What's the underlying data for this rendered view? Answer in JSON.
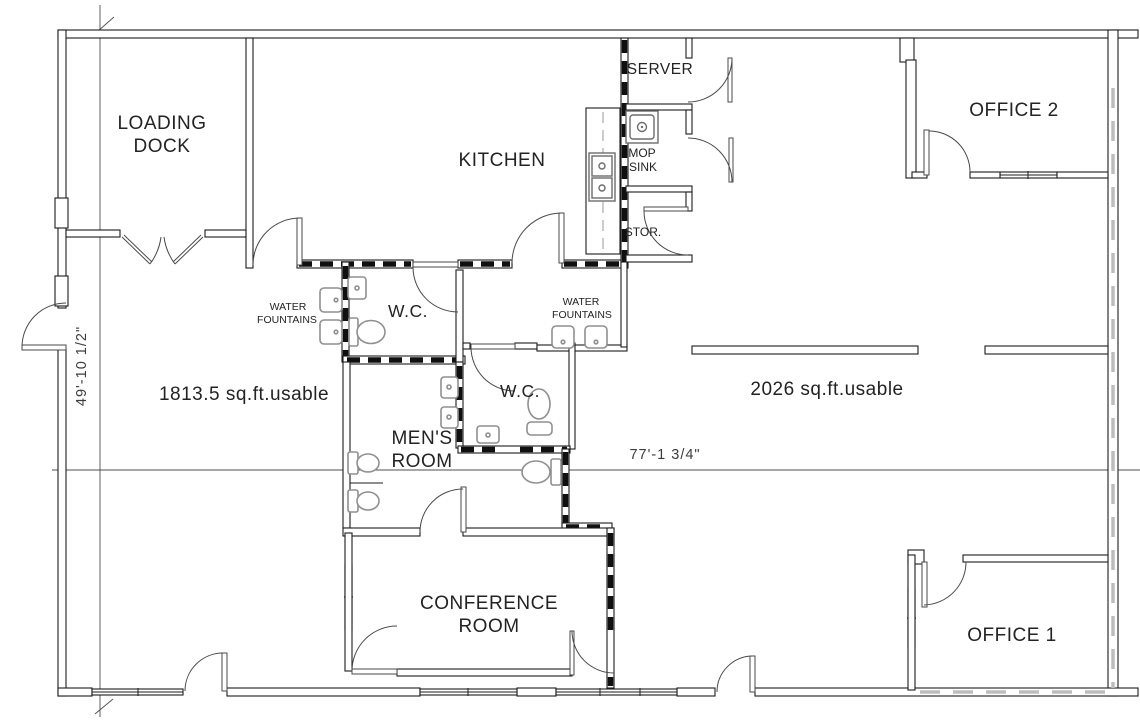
{
  "labels": {
    "loading_dock": [
      "LOADING",
      "DOCK"
    ],
    "kitchen": "KITCHEN",
    "server": "SERVER",
    "mop_sink": [
      "MOP",
      "SINK"
    ],
    "storage": "STOR.",
    "office_2": "OFFICE 2",
    "wc_north": "W.C.",
    "wc_south": "W.C.",
    "water_fountains_west": [
      "WATER",
      "FOUNTAINS"
    ],
    "water_fountains_east": [
      "WATER",
      "FOUNTAINS"
    ],
    "mens_room": [
      "MEN'S",
      "ROOM"
    ],
    "conference_room": [
      "CONFERENCE",
      "ROOM"
    ],
    "office_1": "OFFICE 1"
  },
  "areas": {
    "west": "1813.5 sq.ft.usable",
    "east": "2026 sq.ft.usable"
  },
  "dimensions": {
    "width": "77'-1 3/4\"",
    "height": "49'-10 1/2\""
  },
  "colors": {
    "wall": "#1c1c1c",
    "demising_dash": "#101010",
    "fixture": "#8f8f8f",
    "boundary_dash": "#bdbdbd",
    "background": "#ffffff"
  }
}
